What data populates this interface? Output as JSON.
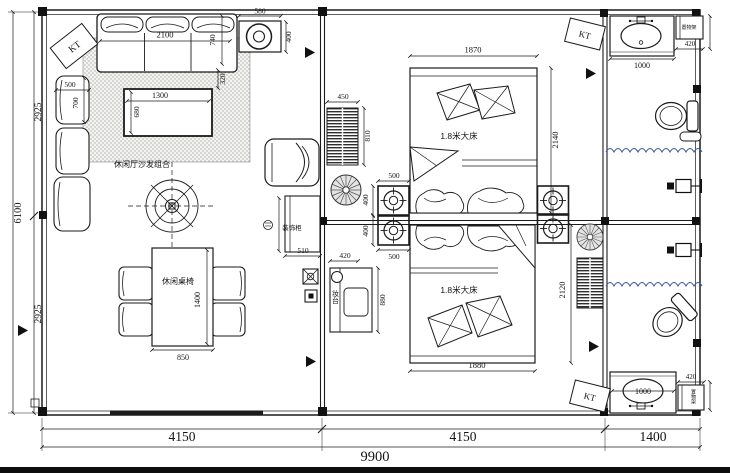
{
  "drawing": {
    "type": "residential floor plan",
    "labels": {
      "kt_a": "KT",
      "kt_b": "KT",
      "kt_c": "KT",
      "sofa_group": "休闲厅沙发组合",
      "dining_set": "休闲桌椅",
      "bed_top": "1.8米大床",
      "bed_bottom": "1.8米大床",
      "decor_cabinet": "装饰柜",
      "dresser": "妆台",
      "shelf_top": "置物架",
      "shelf_bottom": "置物架"
    },
    "dims": {
      "overall_w": "9900",
      "bay1": "4150",
      "bay2": "4150",
      "bay3": "1400",
      "overall_h": "6100",
      "h_top": "2925",
      "h_bottom": "2925",
      "ceiling_box_w": "580",
      "ceiling_box_h": "400",
      "sofa_w": "2100",
      "sofa_d": "740",
      "sofa_gap": "320",
      "chair_w": "500",
      "chair_d": "700",
      "coffee_w": "1300",
      "coffee_d": "680",
      "dining_w": "850",
      "dining_l": "1400",
      "ac_w": "450",
      "ac_h": "810",
      "dl_w_top": "500",
      "dl_h_top": "400",
      "dl_h_bot": "400",
      "dl_w_bot": "500",
      "bed1_w": "1870",
      "bed1_l": "2140",
      "bed2_w": "1880",
      "bed2_l": "2120",
      "dresser_w": "420",
      "dresser_l": "880",
      "cabinet_w": "510",
      "sink1_w": "1000",
      "shelf1_w": "420",
      "sink2_w": "1000",
      "shelf2_w": "420"
    },
    "colors": {
      "line": "#1b1b1b",
      "curtain_blue": "#3f58a6",
      "hatch_gray": "#999999"
    }
  }
}
